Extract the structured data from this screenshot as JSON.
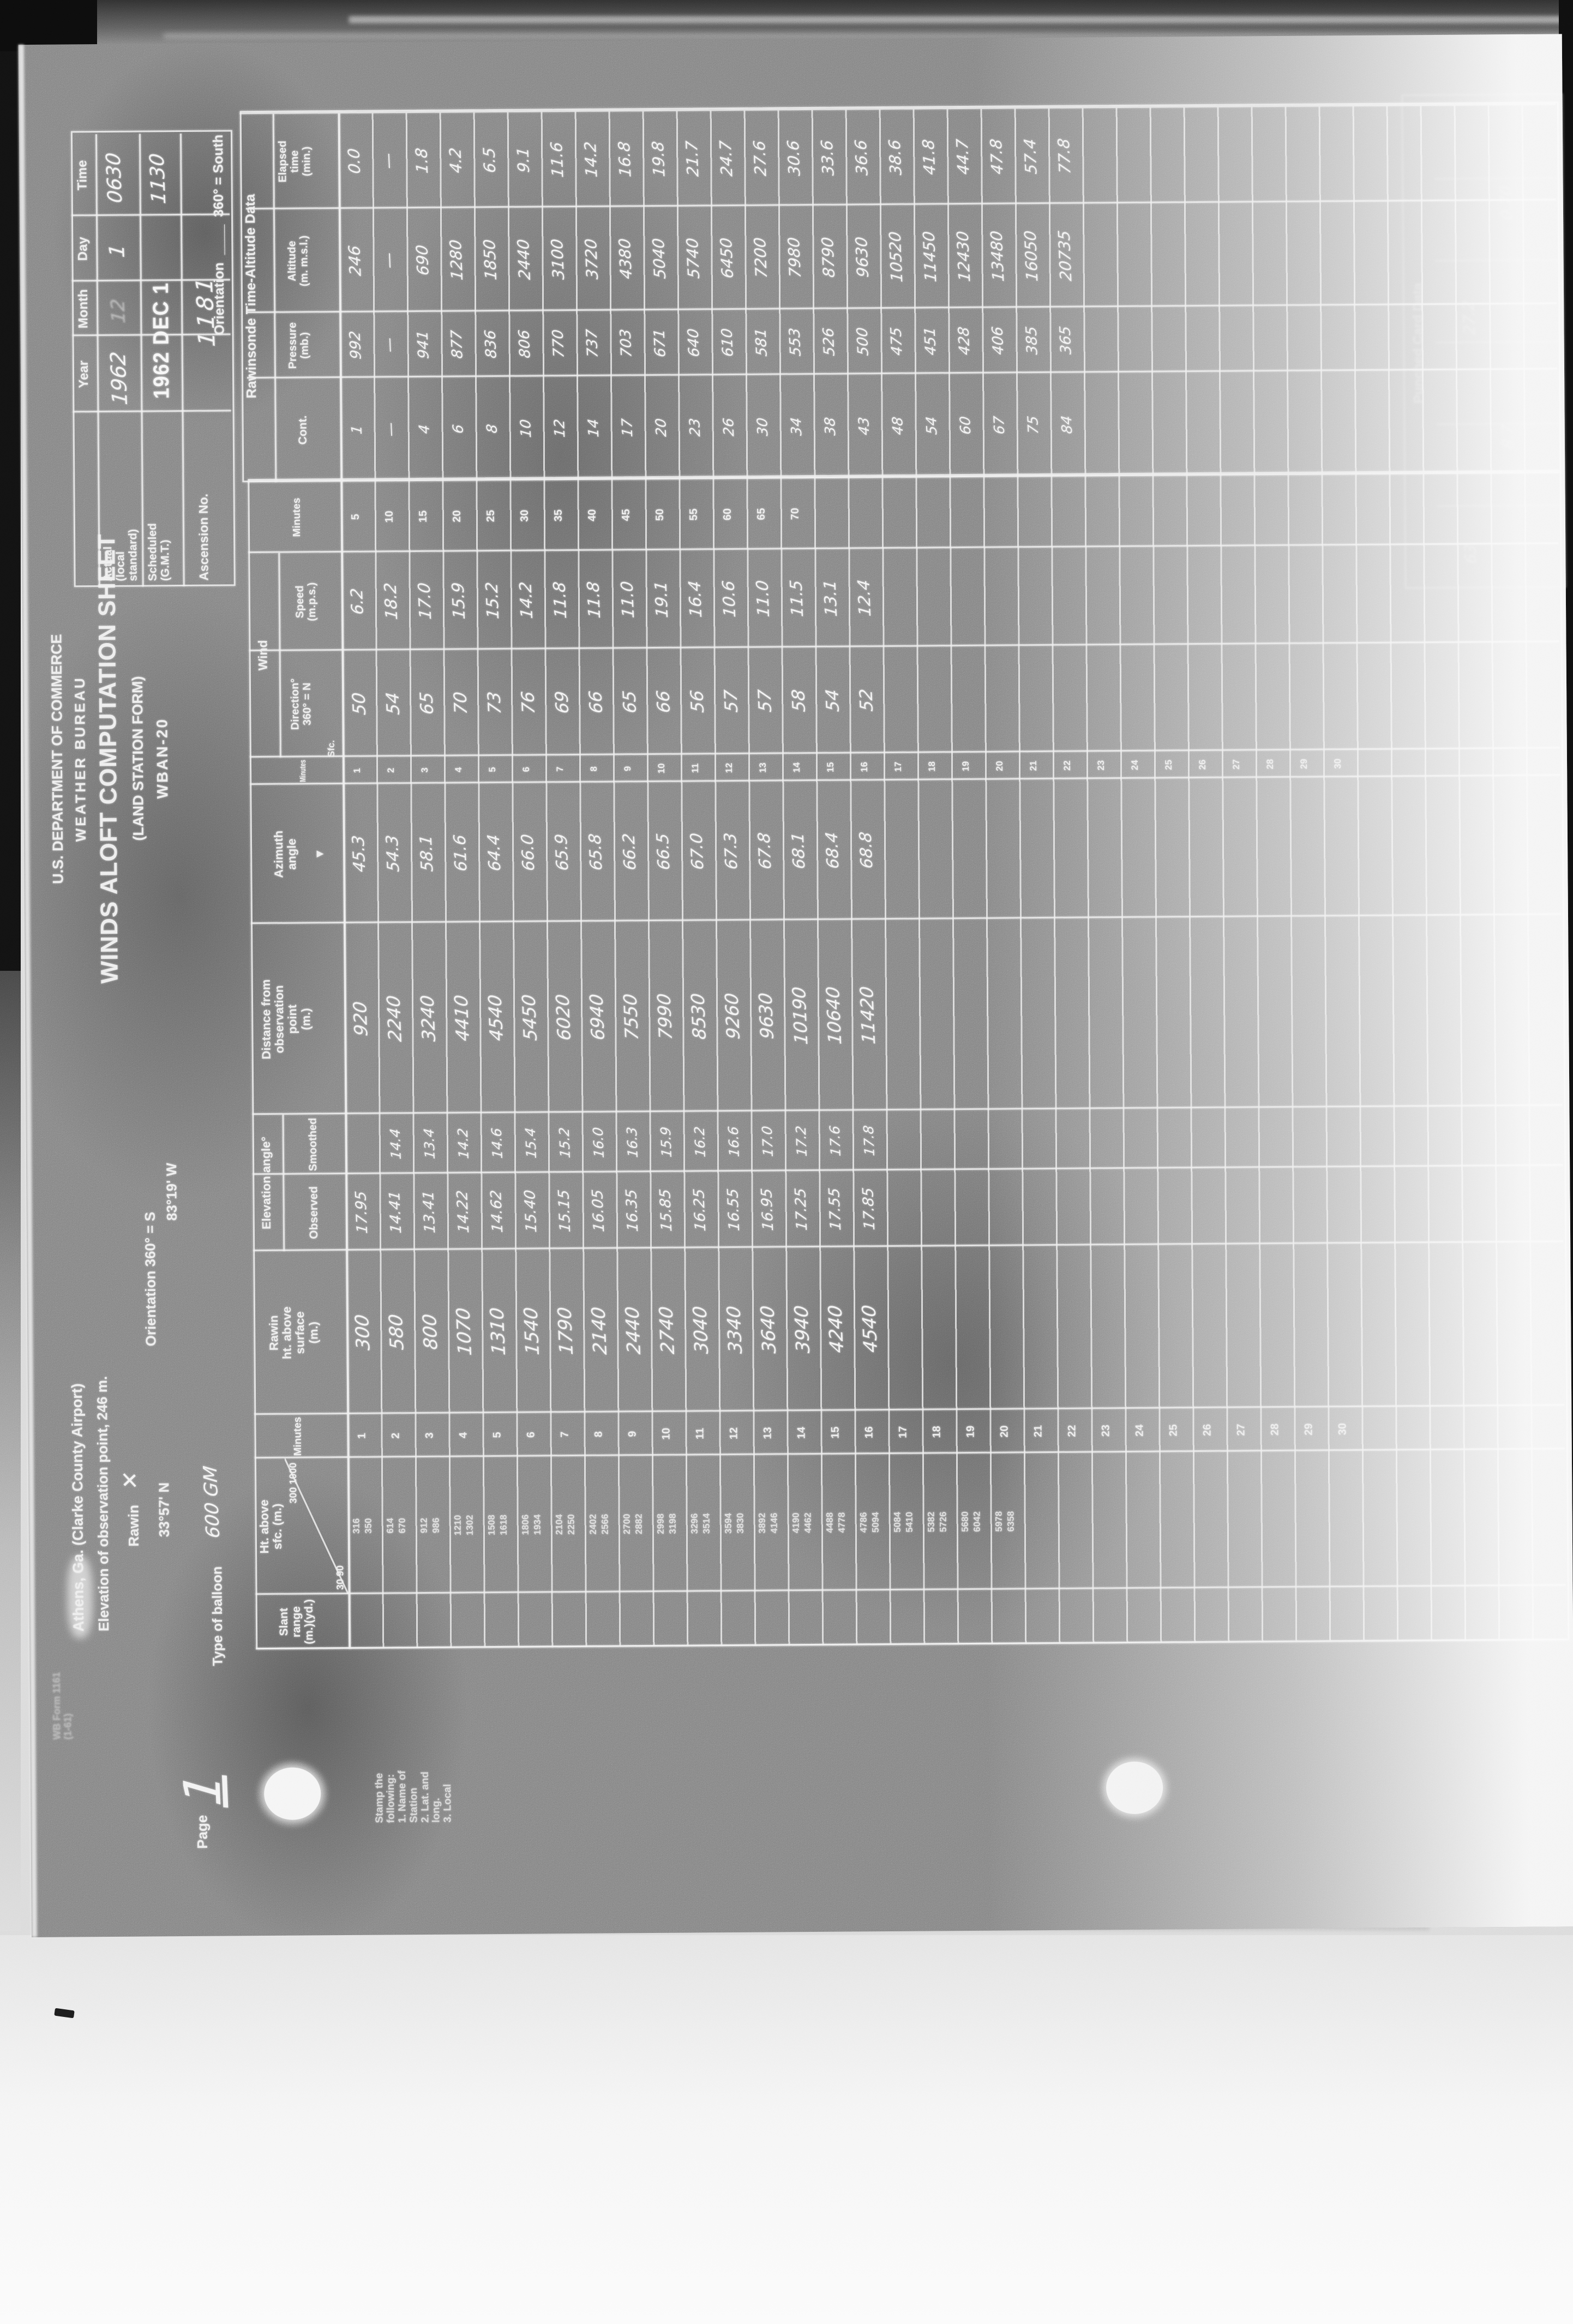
{
  "document": {
    "agency_line1": "U.S. DEPARTMENT OF COMMERCE",
    "agency_line2": "WEATHER BUREAU",
    "title": "WINDS ALOFT COMPUTATION SHEET",
    "subtitle": "(LAND STATION FORM)",
    "form_number": "WBAN-20"
  },
  "date_grid": {
    "col_headers": [
      "Year",
      "Month",
      "Day",
      "Time"
    ],
    "actual": {
      "label": "Actual (local standard)",
      "year": "1962",
      "month": "12",
      "day": "1",
      "time": "0630"
    },
    "scheduled": {
      "label": "Scheduled (G.M.T.)",
      "stamp": "1962 DEC 1",
      "time": "1130"
    },
    "ascension": {
      "label": "Ascension No.",
      "value": "1181"
    }
  },
  "station": {
    "line1": "Athens, Ga. (Clarke County Airport)",
    "line2": "Elevation of observation point, 246 m.",
    "rawin_label": "Rawin",
    "rawin_mark": "✕",
    "latitude": "33°57' N",
    "longitude": "83°19' W",
    "orientation": "Orientation 360° = S"
  },
  "balloon": {
    "label": "Type of balloon",
    "value": "600 GM"
  },
  "orientation_note": {
    "label": "Orientation",
    "value": "360° = South"
  },
  "rawinsonde_section": {
    "title": "Rawinsonde Time-Altitude Data",
    "headers": {
      "cont": "Cont.",
      "pressure": [
        "Pressure",
        "(mb.)"
      ],
      "altitude": [
        "Altitude",
        "(m. m.s.l.)"
      ],
      "elapsed": [
        "Elapsed",
        "time",
        "(min.)"
      ]
    },
    "rows": {
      "cont": [
        "1",
        "—",
        "4",
        "6",
        "8",
        "10",
        "12",
        "14",
        "17",
        "20",
        "23",
        "26",
        "30",
        "34",
        "38",
        "43",
        "48",
        "54",
        "60",
        "67",
        "75",
        "84"
      ],
      "pressure": [
        "992",
        "—",
        "941",
        "877",
        "836",
        "806",
        "770",
        "737",
        "703",
        "671",
        "640",
        "610",
        "581",
        "553",
        "526",
        "500",
        "475",
        "451",
        "428",
        "406",
        "385",
        "365"
      ],
      "altitude": [
        "246",
        "—",
        "690",
        "1280",
        "1850",
        "2440",
        "3100",
        "3720",
        "4380",
        "5040",
        "5740",
        "6450",
        "7200",
        "7980",
        "8790",
        "9630",
        "10520",
        "11450",
        "12430",
        "13480",
        "16050",
        "20735"
      ],
      "elapsed": [
        "0.0",
        "—",
        "1.8",
        "4.2",
        "6.5",
        "9.1",
        "11.6",
        "14.2",
        "16.8",
        "19.8",
        "21.7",
        "24.7",
        "27.6",
        "30.6",
        "33.6",
        "36.6",
        "38.6",
        "41.8",
        "44.7",
        "47.8",
        "57.4",
        "77.8"
      ]
    }
  },
  "main_table": {
    "headers": {
      "slant": [
        "Slant",
        "range",
        "(m.)(yd.)"
      ],
      "ht_sfc": [
        "Ht. above",
        "sfc. (m.)"
      ],
      "minutes": "Minutes",
      "rawin_ht": [
        "Rawin",
        "ht. above",
        "surface",
        "(m.)"
      ],
      "elev_group": "Elevation angle°",
      "elev_obs": "Observed",
      "elev_smo": "Smoothed",
      "distance": [
        "Distance from",
        "observation",
        "point",
        "(m.)"
      ],
      "azimuth": [
        "Azimuth",
        "angle"
      ],
      "azimuth_mark": "▼",
      "wind_group": "Wind",
      "wind_dir": [
        "Direction°",
        "360° = N"
      ],
      "wind_spd": [
        "Speed",
        "(m.p.s.)"
      ],
      "surface_label": "Sfc."
    },
    "diagonal_cell": {
      "upper": "300  1000",
      "lower": "30  90"
    },
    "preprinted_heights": [
      [
        "316",
        "350"
      ],
      [
        "614",
        "670"
      ],
      [
        "912",
        "986"
      ],
      [
        "1210",
        "1302"
      ],
      [
        "1508",
        "1618"
      ],
      [
        "1806",
        "1934"
      ],
      [
        "2104",
        "2250"
      ],
      [
        "2402",
        "2566"
      ],
      [
        "2700",
        "2882"
      ],
      [
        "2998",
        "3198"
      ],
      [
        "3296",
        "3514"
      ],
      [
        "3594",
        "3830"
      ],
      [
        "3892",
        "4146"
      ],
      [
        "4190",
        "4462"
      ],
      [
        "4488",
        "4778"
      ],
      [
        "4786",
        "5094"
      ],
      [
        "5084",
        "5410"
      ],
      [
        "5382",
        "5726"
      ],
      [
        "5680",
        "6042"
      ],
      [
        "5978",
        "6358"
      ]
    ],
    "minutes_left": [
      "1",
      "2",
      "3",
      "4",
      "5",
      "6",
      "7",
      "8",
      "9",
      "10",
      "11",
      "12",
      "13",
      "14",
      "15",
      "16",
      "17",
      "18",
      "19",
      "20",
      "21",
      "22",
      "23",
      "24",
      "25",
      "26",
      "27",
      "28",
      "29",
      "30"
    ],
    "minutes_right": [
      "5",
      "10",
      "15",
      "20",
      "25",
      "30",
      "35",
      "40",
      "45",
      "50",
      "55",
      "60",
      "65",
      "70"
    ],
    "data": {
      "rawin_ht": [
        "300",
        "580",
        "800",
        "1070",
        "1310",
        "1540",
        "1790",
        "2140",
        "2440",
        "2740",
        "3040",
        "3340",
        "3640",
        "3940",
        "4240",
        "4540"
      ],
      "elev_obs": [
        "17.95",
        "14.41",
        "13.41",
        "14.22",
        "14.62",
        "15.40",
        "15.15",
        "16.05",
        "16.35",
        "15.85",
        "16.25",
        "16.55",
        "16.95",
        "17.25",
        "17.55",
        "17.85"
      ],
      "elev_smo": [
        "",
        "14.4",
        "13.4",
        "14.2",
        "14.6",
        "15.4",
        "15.2",
        "16.0",
        "16.3",
        "15.9",
        "16.2",
        "16.6",
        "17.0",
        "17.2",
        "17.6",
        "17.8"
      ],
      "distance": [
        "920",
        "2240",
        "3240",
        "4410",
        "4540",
        "5450",
        "6020",
        "6940",
        "7550",
        "7990",
        "8530",
        "9260",
        "9630",
        "10190",
        "10640",
        "11420"
      ],
      "azimuth": [
        "45.3",
        "54.3",
        "58.1",
        "61.6",
        "64.4",
        "66.0",
        "65.9",
        "65.8",
        "66.2",
        "66.5",
        "67.0",
        "67.3",
        "67.8",
        "68.1",
        "68.4",
        "68.8"
      ],
      "wind_dir": [
        "50",
        "54",
        "65",
        "70",
        "73",
        "76",
        "69",
        "66",
        "65",
        "66",
        "56",
        "57",
        "57",
        "58",
        "54",
        "52"
      ],
      "wind_spd": [
        "6.2",
        "18.2",
        "17.0",
        "15.9",
        "15.2",
        "14.2",
        "11.8",
        "11.8",
        "11.0",
        "19.1",
        "16.4",
        "10.6",
        "11.0",
        "11.5",
        "13.1",
        "12.4"
      ]
    }
  },
  "punched_card": {
    "title": "Punched Card Data",
    "faint_values": [
      "63",
      "8.7",
      "27.2",
      "0.70"
    ]
  },
  "margin": {
    "page_label": "Page",
    "page_number": "1",
    "stamp_note": [
      "Stamp the",
      "following:",
      "1. Name of",
      "Station",
      "2. Lat. and",
      "long.",
      "3. Local"
    ],
    "form_footer_line1": "WB Form 1161",
    "form_footer_line2": "(1-61)"
  }
}
